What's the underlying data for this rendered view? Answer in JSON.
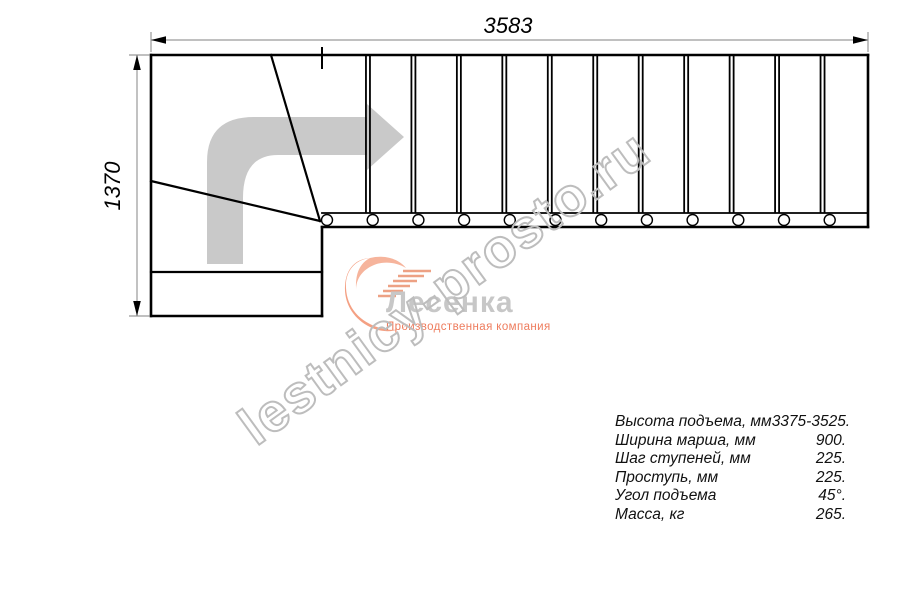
{
  "drawing": {
    "top_dimension": "3583",
    "left_dimension": "1370",
    "straight_treads": 12,
    "winder_lines": 2,
    "colors": {
      "line": "#000000",
      "dimension": "#9a9a9a",
      "direction_arrow": "#c9c9c9",
      "watermark": "#bdbdbd",
      "logo_name": "#c7c7c7",
      "logo_accent": "#f09a7b"
    }
  },
  "logo": {
    "name": "Лесенка",
    "tagline": "Производственная компания"
  },
  "watermark": "lestnicy-prosto.ru",
  "specs": [
    {
      "label": "Высота подъема, мм",
      "value": "3375-3525."
    },
    {
      "label": "Ширина марша, мм",
      "value": "900."
    },
    {
      "label": "Шаг ступеней, мм",
      "value": "225."
    },
    {
      "label": "Проступь, мм",
      "value": "225."
    },
    {
      "label": "Угол подъема",
      "value": "45°."
    },
    {
      "label": "Масса, кг",
      "value": "265."
    }
  ]
}
